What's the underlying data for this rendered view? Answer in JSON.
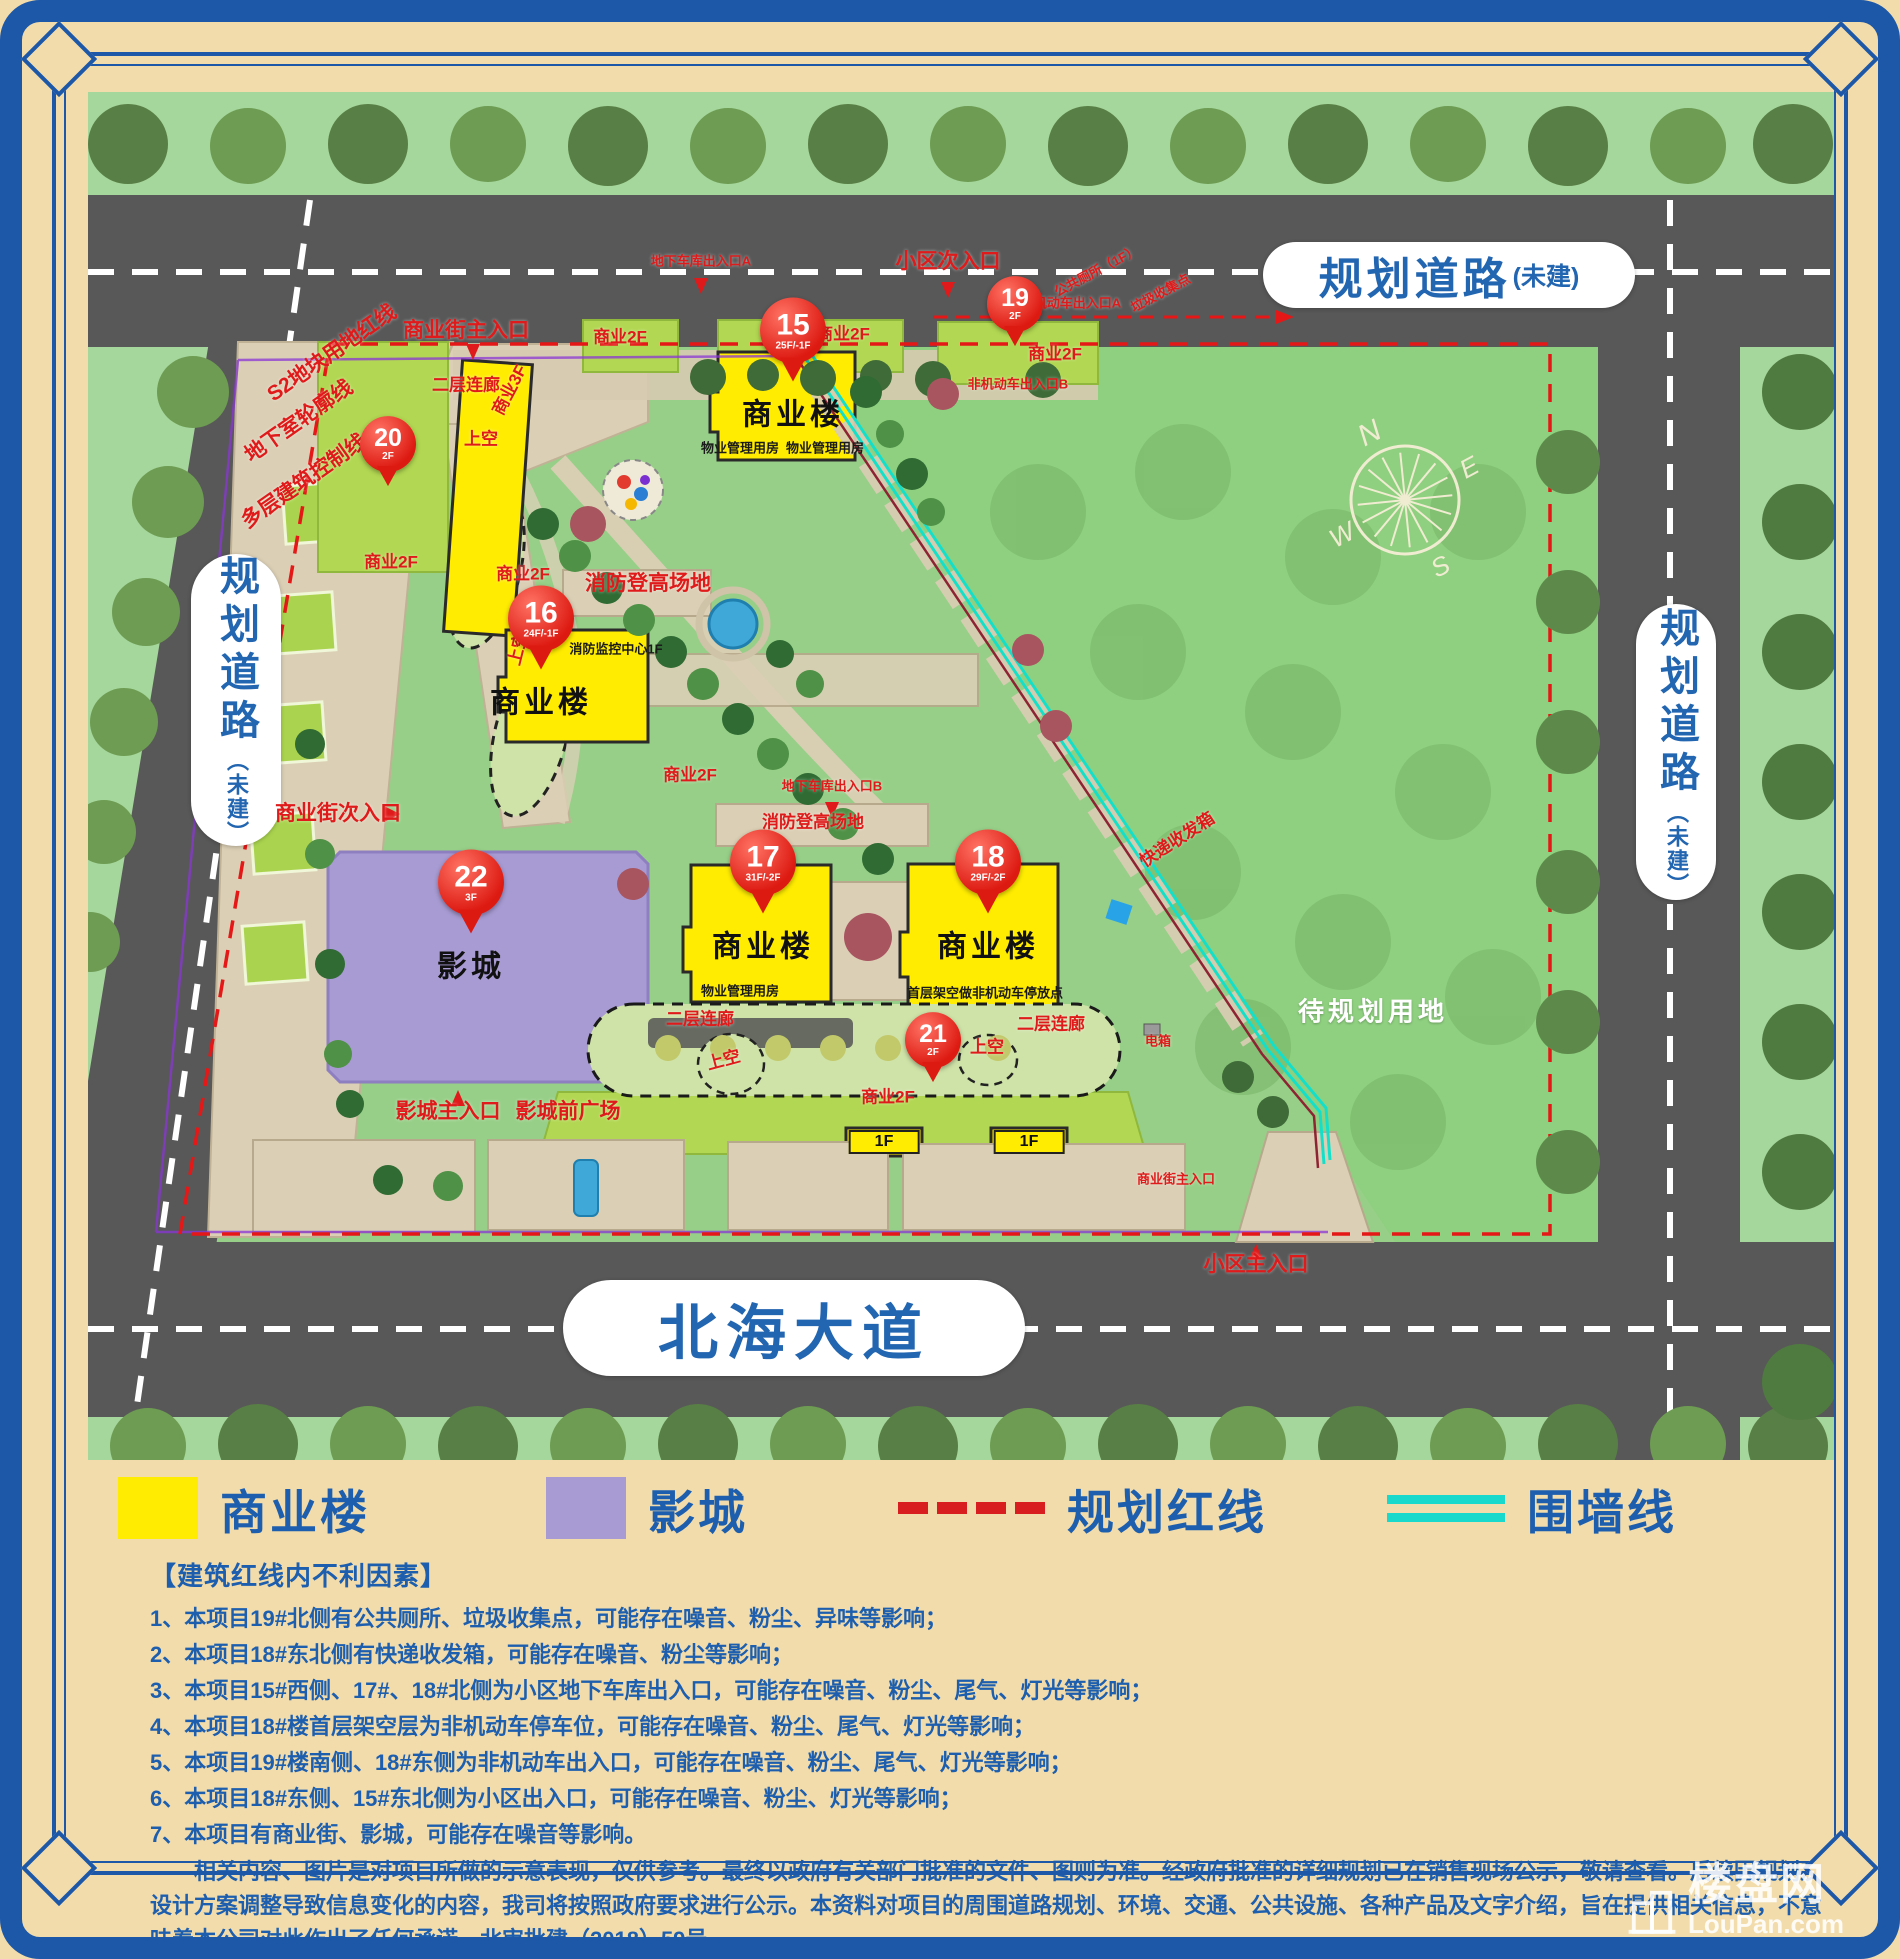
{
  "map": {
    "road_labels": {
      "top": {
        "main": "规划道路",
        "suffix": "(未建)"
      },
      "left": {
        "main": "规划道路",
        "suffix": "（未建）"
      },
      "right": {
        "main": "规划道路",
        "suffix": "（未建）"
      },
      "bottom": {
        "main": "北海大道"
      }
    },
    "compass": {
      "n": "N",
      "e": "E",
      "s": "S",
      "w": "W"
    },
    "pins": [
      {
        "num": "15",
        "floors": "25F/-1F",
        "name": "商业楼"
      },
      {
        "num": "16",
        "floors": "24F/-1F",
        "name": "商业楼"
      },
      {
        "num": "17",
        "floors": "31F/-2F",
        "name": "商业楼"
      },
      {
        "num": "18",
        "floors": "29F/-2F",
        "name": "商业楼"
      },
      {
        "num": "19",
        "floors": "2F",
        "name": ""
      },
      {
        "num": "20",
        "floors": "2F",
        "name": ""
      },
      {
        "num": "21",
        "floors": "2F",
        "name": ""
      },
      {
        "num": "22",
        "floors": "3F",
        "name": "影城"
      }
    ],
    "annotations": [
      {
        "text": "地下车库出入口A"
      },
      {
        "text": "小区次入口"
      },
      {
        "text": "公共厕所（1F）"
      },
      {
        "text": "垃圾收集点"
      },
      {
        "text": "非机动车出入口A"
      },
      {
        "text": "商业2F"
      },
      {
        "text": "商业2F"
      },
      {
        "text": "商业2F"
      },
      {
        "text": "非机动车出入口B"
      },
      {
        "text": "商业街主入口"
      },
      {
        "text": "二层连廊"
      },
      {
        "text": "上空"
      },
      {
        "text": "商业3F"
      },
      {
        "text": "商业2F"
      },
      {
        "text": "商业2F"
      },
      {
        "text": "上空"
      },
      {
        "text": "消防登高场地"
      },
      {
        "text": "消防监控中心1F"
      },
      {
        "text": "商业2F"
      },
      {
        "text": "地下车库出入口B"
      },
      {
        "text": "消防登高场地"
      },
      {
        "text": "商业街次入口"
      },
      {
        "text": "快递收发箱"
      },
      {
        "text": "二层连廊"
      },
      {
        "text": "二层连廊"
      },
      {
        "text": "上空"
      },
      {
        "text": "上空"
      },
      {
        "text": "商业2F"
      },
      {
        "text": "影城主入口"
      },
      {
        "text": "影城前广场"
      },
      {
        "text": "商业街主入口"
      },
      {
        "text": "小区主入口"
      },
      {
        "text": "待规划用地"
      },
      {
        "text": "S2地块用地红线"
      },
      {
        "text": "地下室轮廓线"
      },
      {
        "text": "多层建筑控制线"
      },
      {
        "text": "物业管理用房"
      },
      {
        "text": "物业管理用房"
      },
      {
        "text": "物业管理用房"
      },
      {
        "text": "首层架空做非机动车停放点"
      },
      {
        "text": "1F"
      },
      {
        "text": "1F"
      },
      {
        "text": "电箱"
      }
    ],
    "colors": {
      "building_yellow": "#ffec00",
      "cinema_purple": "#a89bd3",
      "red_line": "#e51717",
      "wall_line": "#19d8cc",
      "pin_red": "#dd1a12"
    }
  },
  "legend": {
    "items": [
      {
        "label": "商业楼"
      },
      {
        "label": "影城"
      },
      {
        "label": "规划红线"
      },
      {
        "label": "围墙线"
      }
    ]
  },
  "notes": {
    "header": "【建筑红线内不利因素】",
    "items": [
      "1、本项目19#北侧有公共厕所、垃圾收集点，可能存在噪音、粉尘、异味等影响；",
      "2、本项目18#东北侧有快递收发箱，可能存在噪音、粉尘等影响；",
      "3、本项目15#西侧、17#、18#北侧为小区地下车库出入口，可能存在噪音、粉尘、尾气、灯光等影响；",
      "4、本项目18#楼首层架空层为非机动车停车位，可能存在噪音、粉尘、尾气、灯光等影响；",
      "5、本项目19#楼南侧、18#东侧为非机动车出入口，可能存在噪音、粉尘、尾气、灯光等影响；",
      "6、本项目18#东侧、15#东北侧为小区出入口，可能存在噪音、粉尘、灯光等影响；",
      "7、本项目有商业街、影城，可能存在噪音等影响。"
    ],
    "disclaimer": "相关内容、图片是对项目所做的示意表现，仅供参考。最终以政府有关部门批准的文件、图则为准。经政府批准的详细规划已在销售现场公示，敬请查看。后续因规划及设计方案调整导致信息变化的内容，我司将按照政府要求进行公示。本资料对项目的周围道路规划、环境、交通、公共设施、各种产品及文字介绍，旨在提供相关信息，不意味着本公司对此作出了任何承诺。北审批建（2018）59号"
  },
  "watermark": {
    "title": "楼盘网",
    "subtitle": "LouPan.com"
  }
}
